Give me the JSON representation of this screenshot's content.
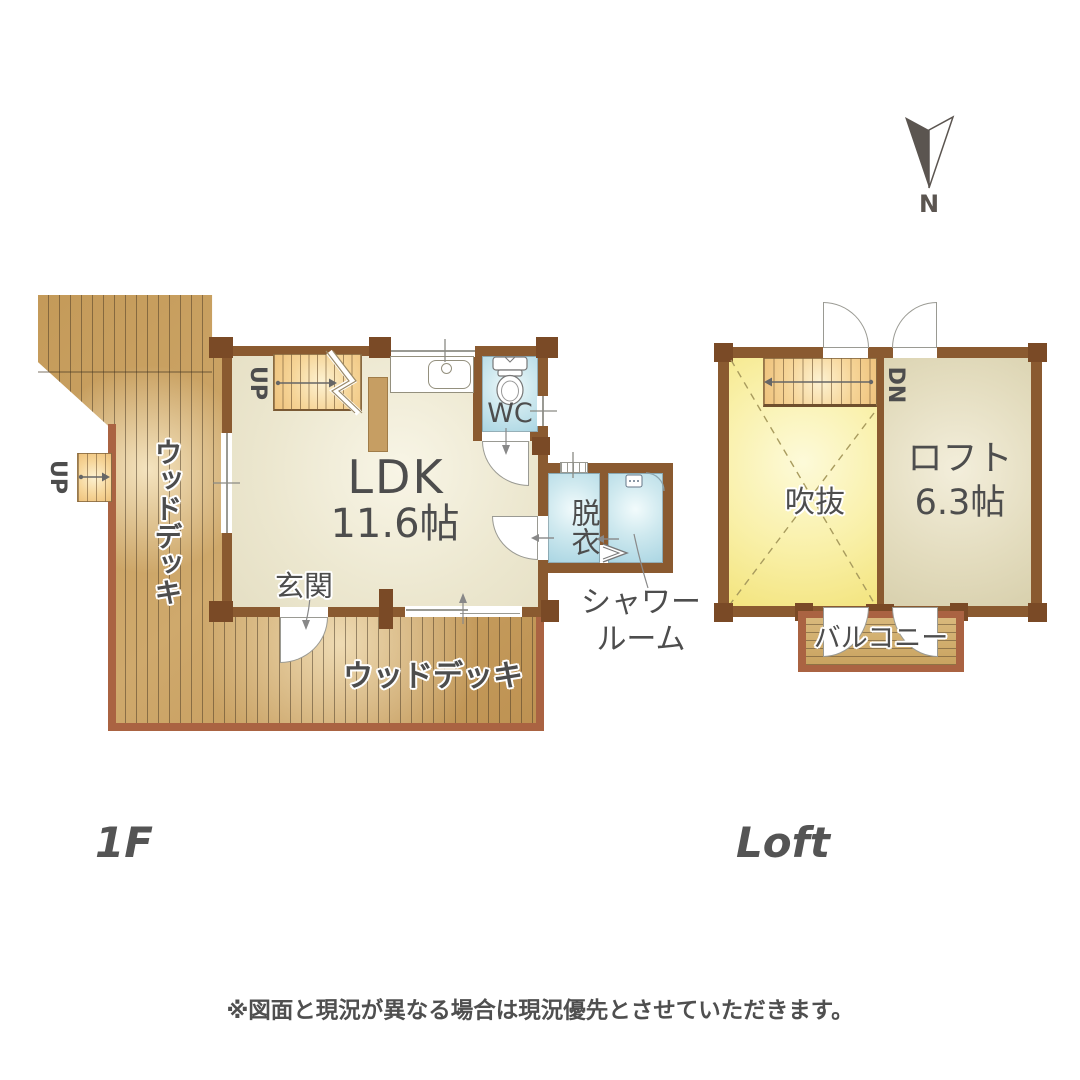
{
  "compass": {
    "label": "N"
  },
  "floor1": {
    "label": "1F",
    "ldk_name": "LDK",
    "ldk_size": "11.6帖",
    "wc": "WC",
    "entrance": "玄関",
    "dressing": "脱衣",
    "shower_line1": "シャワー",
    "shower_line2": "ルーム",
    "wood_deck_side": "ウッドデッキ",
    "wood_deck_bottom": "ウッドデッキ",
    "stairs_up": "UP",
    "deck_steps_up": "UP"
  },
  "loft": {
    "label": "Loft",
    "void": "吹抜",
    "loft_name": "ロフト",
    "loft_size": "6.3帖",
    "balcony": "バルコニー",
    "stairs_down": "DN"
  },
  "footer": {
    "disclaimer": "※図面と現況が異なる場合は現況優先とさせていただきます。"
  },
  "colors": {
    "wall": "#8a5a30",
    "post": "#7a4a26",
    "deck_wood": "#cba263",
    "deck_border": "#aa6342",
    "floor_beige": "#ece7cf",
    "wet_room_blue": "#bfe0ea",
    "stair_orange": "#f6d598",
    "void_yellow": "#f9f0a8",
    "loft_beige": "#e3dcbe",
    "label_text": "#4d4d4d"
  }
}
